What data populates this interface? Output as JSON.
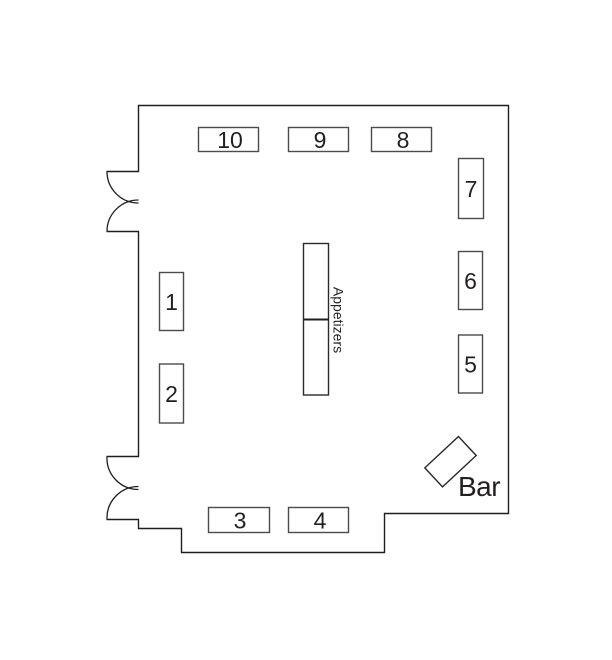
{
  "floor_plan": {
    "tables": [
      {
        "label": "1"
      },
      {
        "label": "2"
      },
      {
        "label": "3"
      },
      {
        "label": "4"
      },
      {
        "label": "5"
      },
      {
        "label": "6"
      },
      {
        "label": "7"
      },
      {
        "label": "8"
      },
      {
        "label": "9"
      },
      {
        "label": "10"
      }
    ],
    "appetizers_table": {
      "label": "Appetizers"
    },
    "bar": {
      "label": "Bar"
    },
    "doors": {
      "upper_left": "double-swing-door",
      "lower_left": "double-swing-door"
    },
    "colors": {
      "background": "#ffffff",
      "wall_line": "#1f1f1f",
      "table_border": "#4b4b4b",
      "text": "#231f20"
    }
  }
}
